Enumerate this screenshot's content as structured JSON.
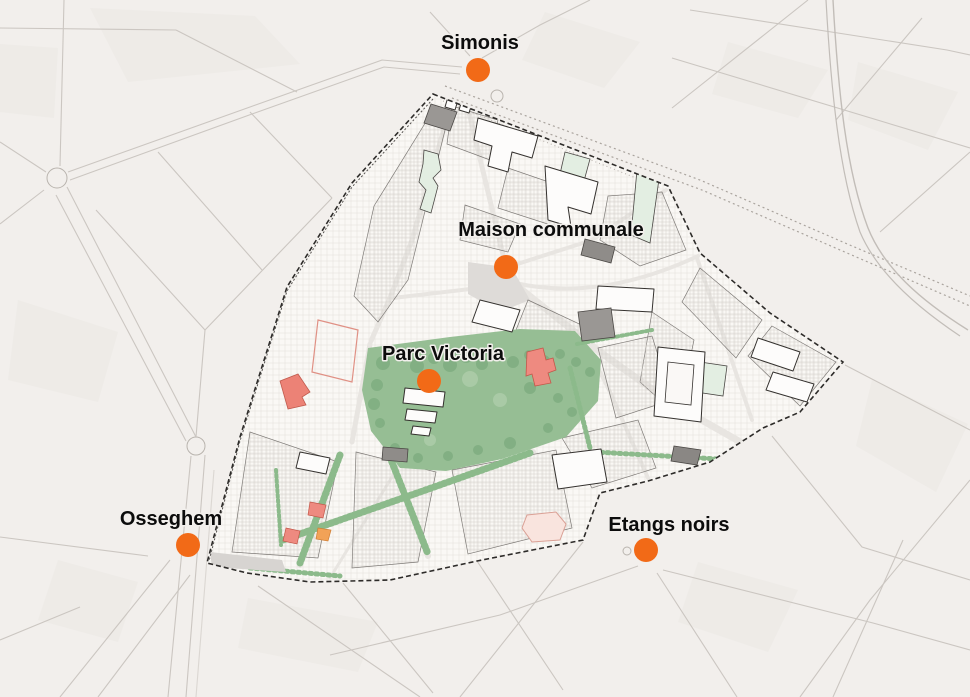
{
  "map": {
    "description": "Urban plan map with highlighted project perimeter, Parc Victoria and metro station markers"
  },
  "markers": [
    {
      "name": "simonis",
      "label": "Simonis",
      "label_x": 480,
      "label_y": 49,
      "dot_x": 478,
      "dot_y": 70
    },
    {
      "name": "maison-communale",
      "label": "Maison communale",
      "label_x": 551,
      "label_y": 236,
      "dot_x": 506,
      "dot_y": 267
    },
    {
      "name": "parc-victoria",
      "label": "Parc Victoria",
      "label_x": 443,
      "label_y": 360,
      "dot_x": 429,
      "dot_y": 381
    },
    {
      "name": "osseghem",
      "label": "Osseghem",
      "label_x": 171,
      "label_y": 525,
      "dot_x": 188,
      "dot_y": 545
    },
    {
      "name": "etangs-noirs",
      "label": "Etangs noirs",
      "label_x": 669,
      "label_y": 531,
      "dot_x": 646,
      "dot_y": 550
    }
  ],
  "style": {
    "marker_color": "#F26A17",
    "label_color": "#0C0C0C",
    "dot_radius": 12,
    "park_green": "#96BE94",
    "corridor_green": "#8CBA8B",
    "highlight_red": "#EE8A80",
    "background": "#F2EFEC"
  }
}
